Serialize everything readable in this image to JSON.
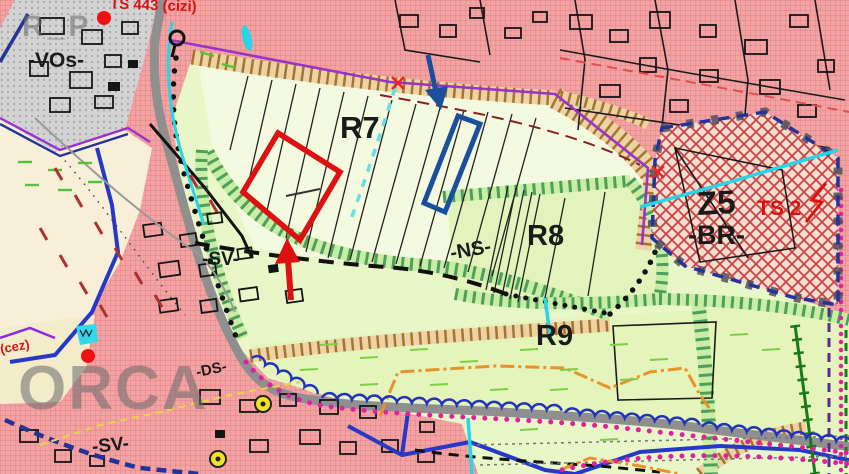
{
  "map": {
    "title": "zoning-plan-map",
    "labels": {
      "zone_r7": "R7",
      "zone_r8": "R8",
      "zone_r9": "R9",
      "zone_z5": "Z5",
      "zone_br": "-BR-",
      "zone_ns": "-NS-",
      "zone_sv_mid": "-SV-",
      "zone_sv_bottom": "-SV-",
      "zone_vos": "-VOs-",
      "zone_ds": "-DS-",
      "ts_station_top": "TS 443 (cizi)",
      "ts_station_z5": "TS 2",
      "cez_note": "(cez)",
      "watermark_main": "ORCA",
      "watermark_corner": "R_P"
    },
    "colors": {
      "highlight_red": "#dd1111",
      "highlight_blue": "#1a4f9e",
      "zone_pink": "#f2a8a8",
      "zone_green": "#e9f6c8",
      "zone_grey": "#d2d2d2",
      "zone_cream": "#f7efd8",
      "z5_hatch_red": "#cc4444",
      "road_grey": "#8f8f8f",
      "cyan_stream": "#25d5e8",
      "magenta_dots": "#e020a0",
      "purple_boundary": "#9933cc",
      "navy_border": "#223399",
      "royal_blue": "#2538c8",
      "orange_line": "#e8922a",
      "dark_green": "#1a7a1a",
      "yellow_symbol": "#f2e22a"
    }
  }
}
